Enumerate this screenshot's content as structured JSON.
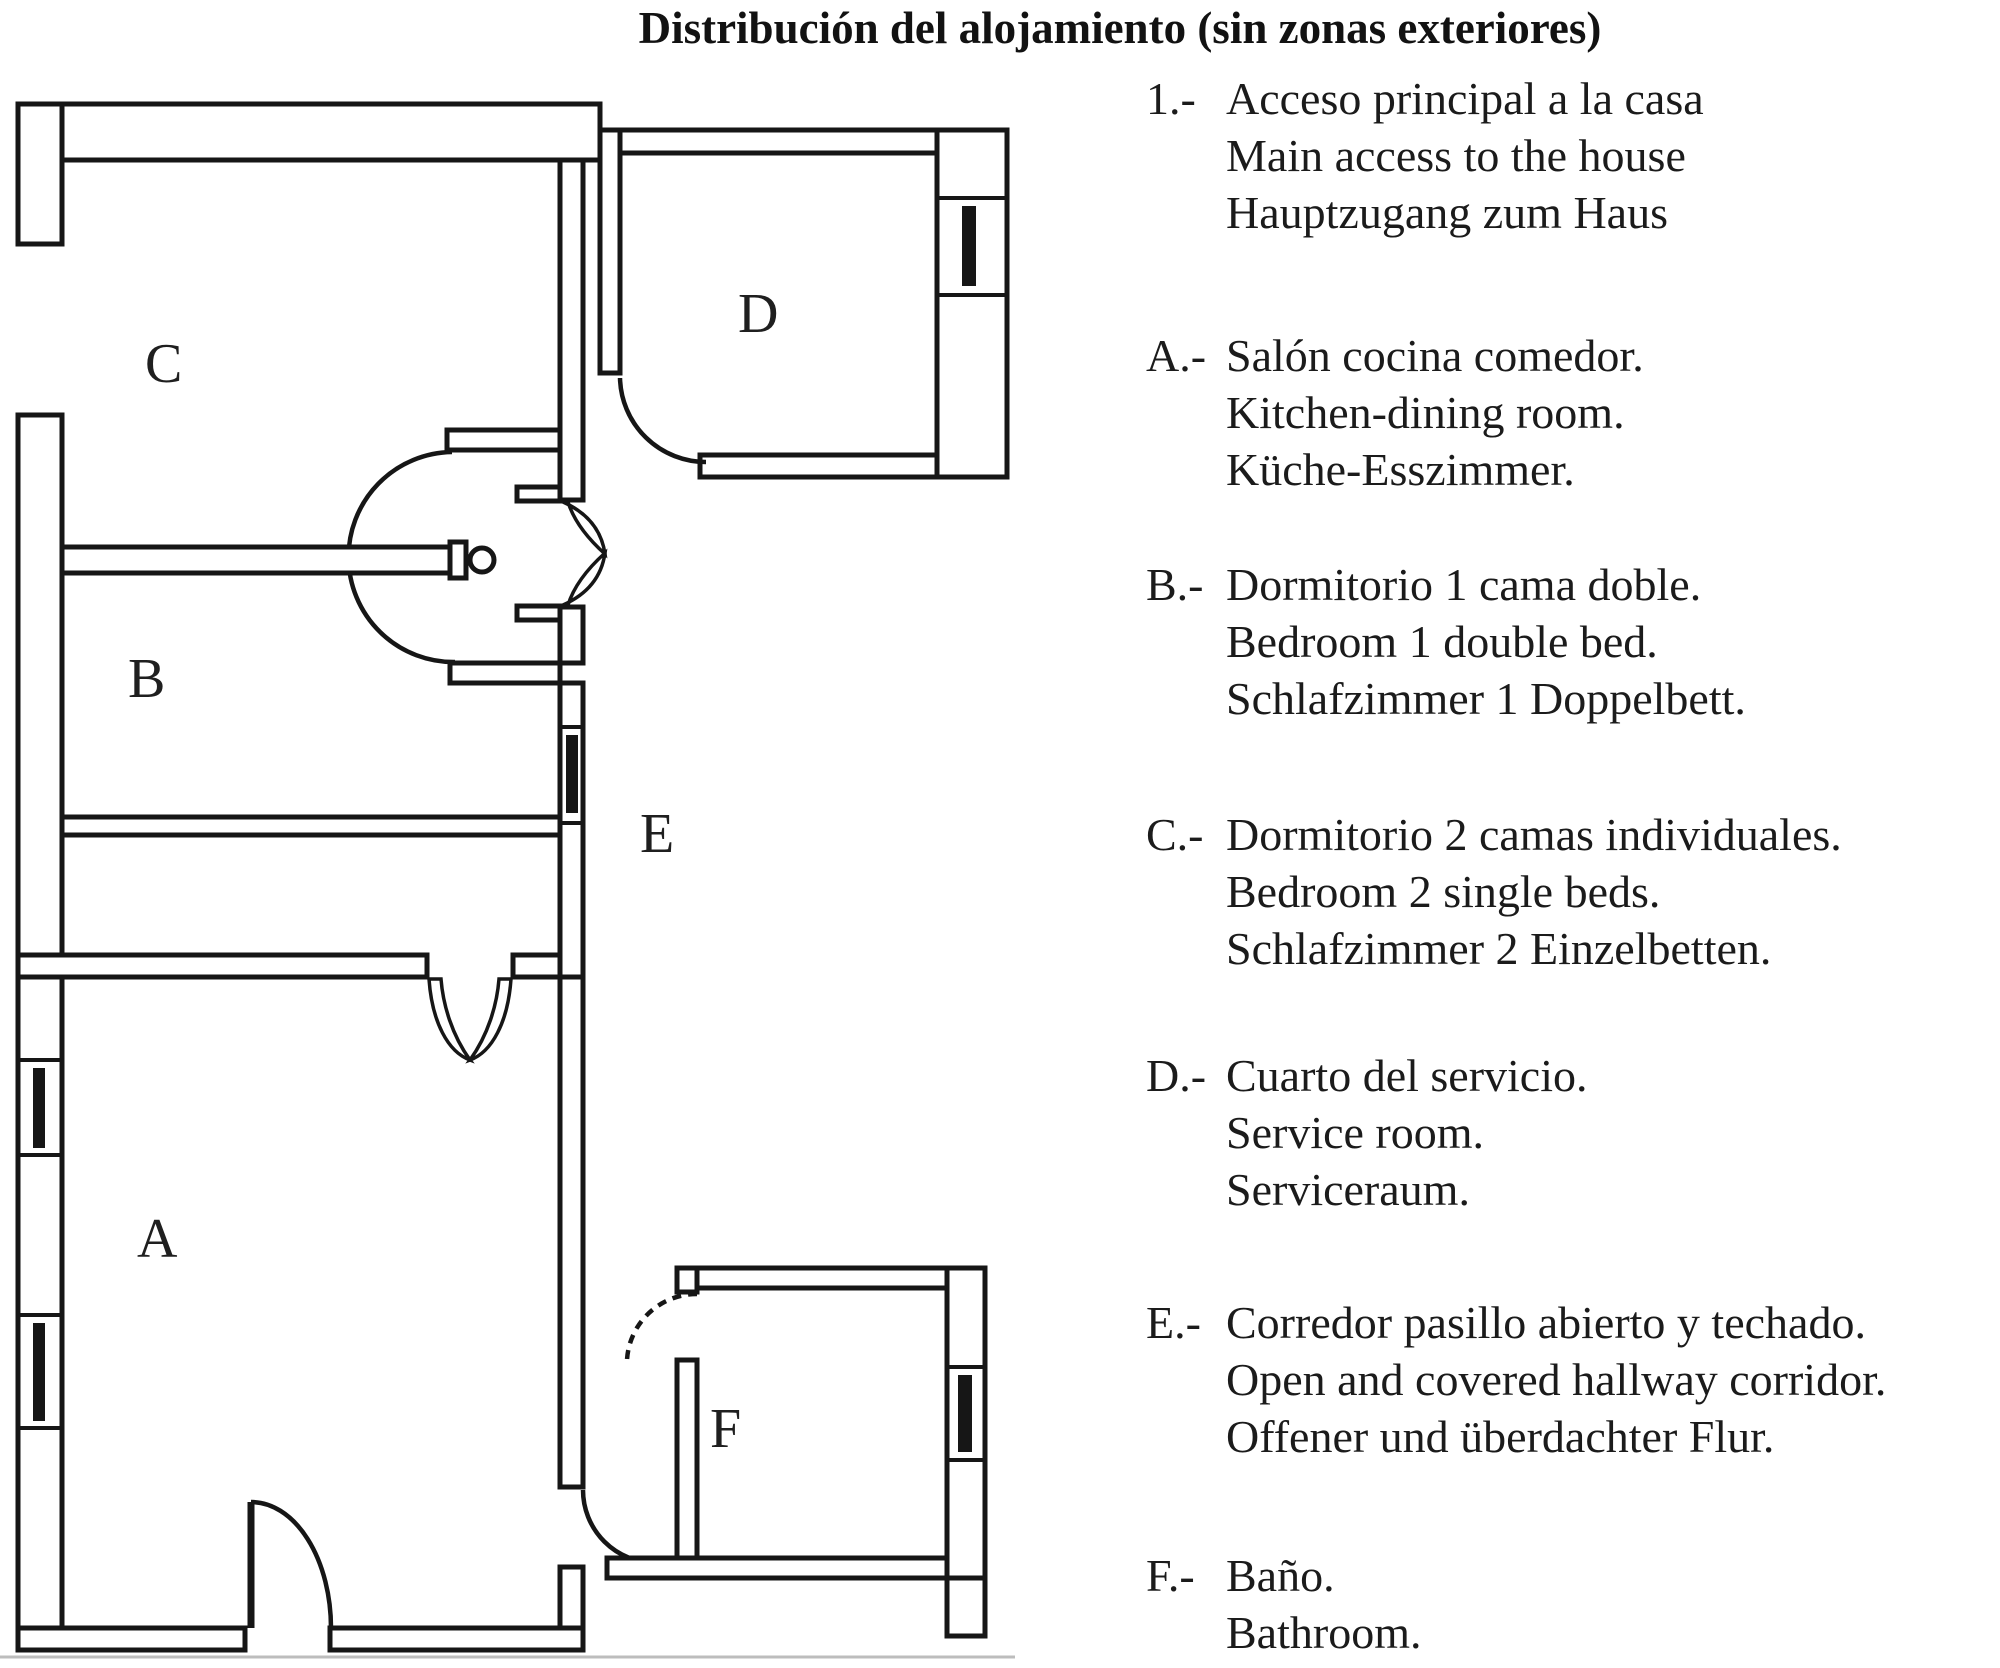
{
  "title": "Distribución del alojamiento (sin zonas exteriores)",
  "legend": {
    "items": [
      {
        "key": "1.-",
        "lines": [
          "Acceso principal a la casa",
          "Main access to the house",
          "Hauptzugang zum Haus"
        ]
      },
      {
        "key": "A.-",
        "lines": [
          "Salón cocina comedor.",
          "Kitchen-dining room.",
          "Küche-Esszimmer."
        ]
      },
      {
        "key": "B.-",
        "lines": [
          "Dormitorio 1 cama doble.",
          "Bedroom 1 double bed.",
          "Schlafzimmer 1 Doppelbett."
        ]
      },
      {
        "key": "C.-",
        "lines": [
          "Dormitorio 2 camas individuales.",
          "Bedroom 2 single beds.",
          "Schlafzimmer 2 Einzelbetten."
        ]
      },
      {
        "key": "D.-",
        "lines": [
          "Cuarto del servicio.",
          "Service room.",
          "Serviceraum."
        ]
      },
      {
        "key": "E.-",
        "lines": [
          "Corredor pasillo abierto y techado.",
          "Open and covered hallway corridor.",
          "Offener und überdachter Flur."
        ]
      },
      {
        "key": "F.-",
        "lines": [
          "Baño.",
          "Bathroom."
        ]
      }
    ]
  },
  "floorplan": {
    "ink_color": "#161616",
    "labels": {
      "a": "A",
      "b": "B",
      "c": "C",
      "d": "D",
      "e": "E",
      "f": "F"
    }
  }
}
